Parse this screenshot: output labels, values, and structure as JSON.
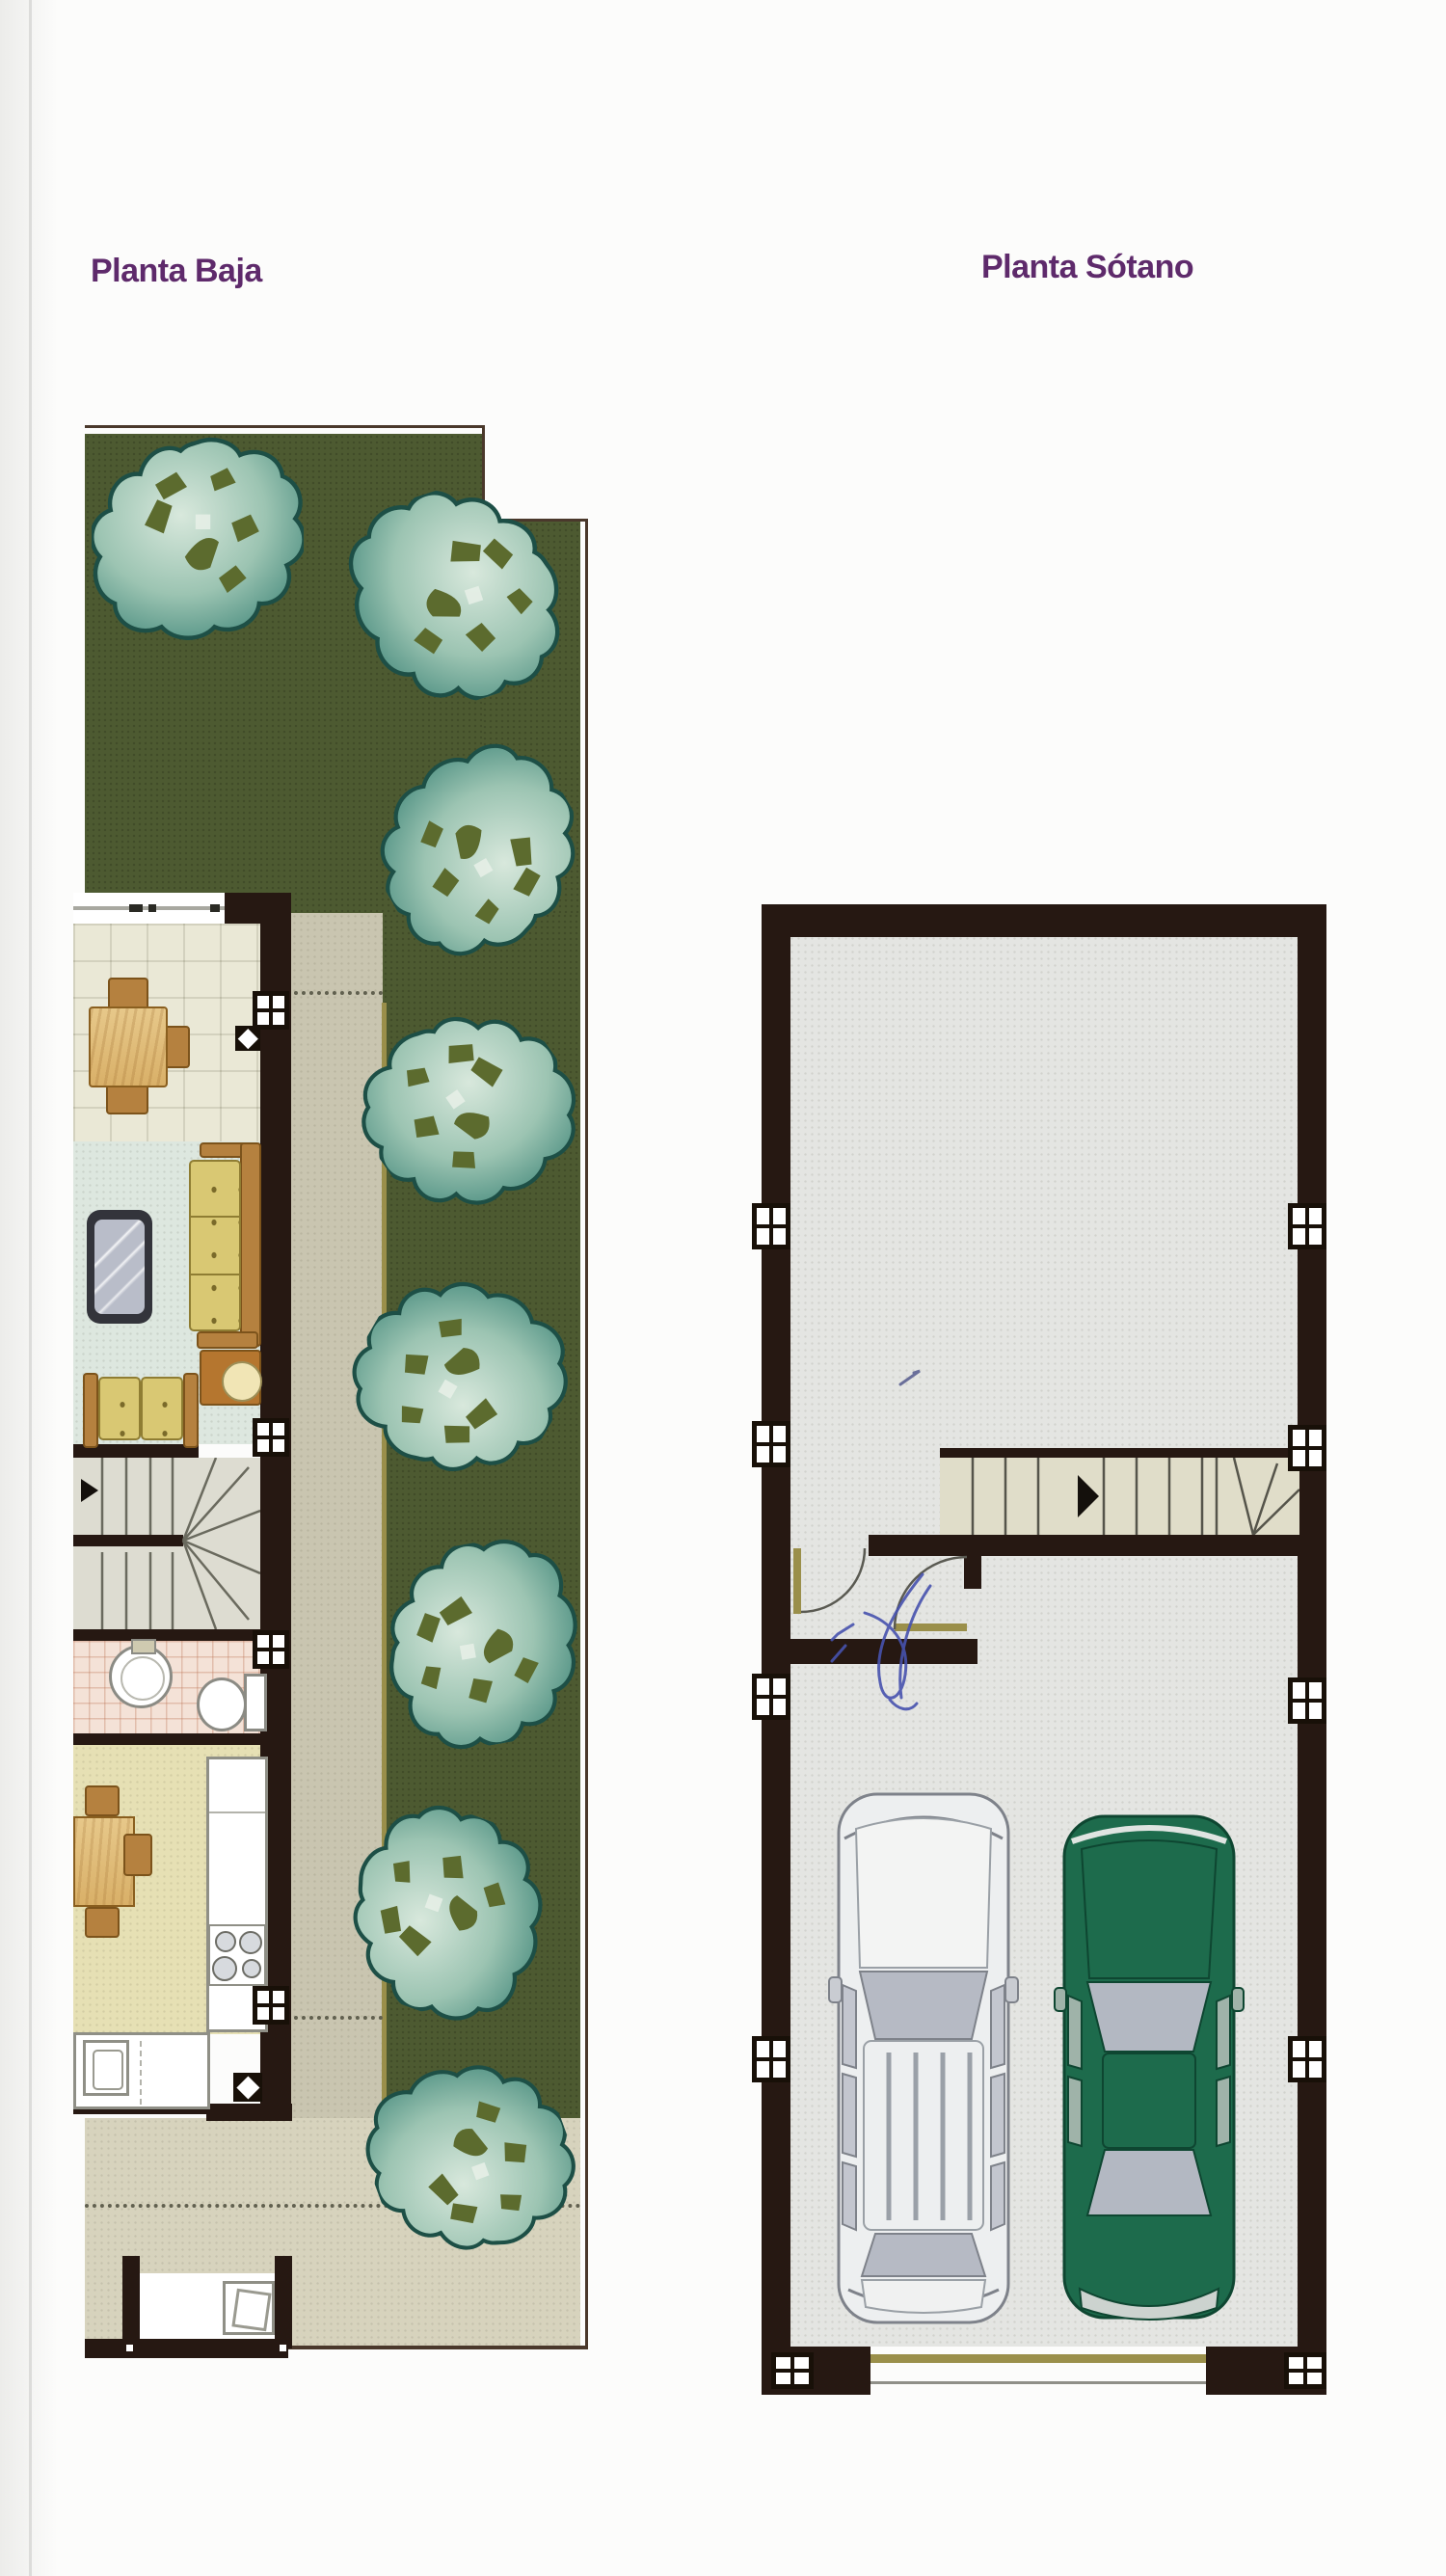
{
  "document": {
    "kind": "scanned architectural floor plan page",
    "titles": {
      "left": "Planta Baja",
      "right": "Planta Sótano"
    }
  },
  "palette": {
    "titleColor": "#5e2a6b",
    "wall": "#261812",
    "garden": "#4d5a31",
    "walkway": "#c9c5b0",
    "patio": "#d7d3bd",
    "diningFloor": "#eae8d6",
    "livingFloor": "#dde7df",
    "stairFloor": "#dddcd1",
    "bathFloor": "#f4e2d7",
    "kitchenFloor": "#e6e0b4",
    "basementFloor": "#e4e5e2",
    "basementStair": "#e0ddc9",
    "doorTan": "#9a8f4a",
    "penInk": "#4752ae",
    "wood": "#b5813f",
    "cushion": "#d9c873"
  },
  "planta_baja": {
    "label": "Planta Baja",
    "trees": 8,
    "wall_windows": 4,
    "wall_vents": 2,
    "furniture": [
      "dining-table",
      "dining-chairs",
      "sofa",
      "loveseat",
      "side-table-lamp",
      "glass-coffee-table",
      "staircase",
      "wash-basin",
      "toilet",
      "kitchen-table",
      "kitchen-counter",
      "stove",
      "kitchen-sink"
    ]
  },
  "planta_sotano": {
    "label": "Planta Sótano",
    "windows": 10,
    "staircase_direction_arrow": "right",
    "doors": 2,
    "cars": [
      {
        "position": "left",
        "body_color": "white"
      },
      {
        "position": "right",
        "body_color": "green"
      }
    ],
    "handwritten_pen_mark": true
  }
}
